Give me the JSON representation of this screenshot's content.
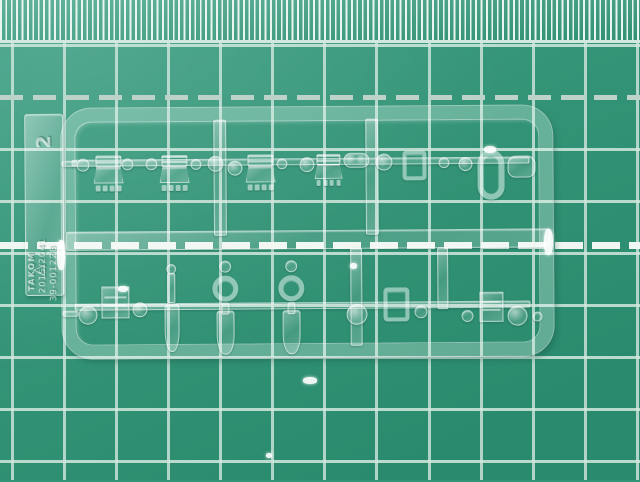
{
  "scene": {
    "description": "Clear transparent plastic model-kit sprue (parts tree) lying on a green self-healing cutting mat with white grid lines",
    "width_px": 640,
    "height_px": 480
  },
  "palette": {
    "mat_green": "#339376",
    "mat_green_light": "#41a287",
    "mat_green_dark": "#2a8a6d",
    "hatch_line": "#e9f5ef",
    "grid_line": "#d2e7de",
    "dash_minor": "#bdd3ca",
    "dash_major": "#f0f6f1"
  },
  "mat": {
    "hatch_band": {
      "height": 43
    },
    "grid": {
      "square_px": 52,
      "vlines": [
        11,
        63,
        115,
        167,
        219,
        271,
        323,
        375,
        428,
        480,
        532,
        584,
        636
      ],
      "hlines": [
        44,
        148,
        200,
        252,
        304,
        356,
        408,
        460
      ],
      "dashed_minor_y": 95,
      "dashed_major_y": 242
    }
  },
  "sprue": {
    "frame": {
      "x": 62,
      "y": 107,
      "w": 491,
      "h": 250,
      "bar_thickness": 13,
      "corner_radius": 30
    },
    "label_tab": {
      "sprue_letter": "2",
      "brand": "TAKOM",
      "code_line1": "2015/2041",
      "code_line2": "39-001228",
      "recycle_symbol": "△"
    },
    "runners": [
      {
        "x": 72,
        "y": 158,
        "w": 458,
        "h": 7
      },
      {
        "x": 66,
        "y": 230,
        "w": 484,
        "h": 19
      },
      {
        "x": 74,
        "y": 302,
        "w": 456,
        "h": 7
      },
      {
        "x": 214,
        "y": 119,
        "w": 13,
        "h": 116
      },
      {
        "x": 366,
        "y": 119,
        "w": 13,
        "h": 116
      },
      {
        "x": 350,
        "y": 248,
        "w": 12,
        "h": 98
      },
      {
        "x": 437,
        "y": 248,
        "w": 11,
        "h": 62
      },
      {
        "x": 62,
        "y": 309,
        "w": 16,
        "h": 6
      },
      {
        "x": 62,
        "y": 159,
        "w": 16,
        "h": 6
      }
    ],
    "parts_top": [
      {
        "type": "disc",
        "x": 83,
        "y": 163,
        "w": 13
      },
      {
        "type": "boxpins",
        "x": 109,
        "y": 172,
        "w": 30,
        "h": 36
      },
      {
        "type": "disc",
        "x": 128,
        "y": 163,
        "w": 12
      },
      {
        "type": "disc",
        "x": 152,
        "y": 163,
        "w": 12
      },
      {
        "type": "boxpins",
        "x": 175,
        "y": 172,
        "w": 30,
        "h": 36
      },
      {
        "type": "disc",
        "x": 196,
        "y": 163,
        "w": 11
      },
      {
        "type": "dome",
        "x": 216,
        "y": 163,
        "w": 16
      },
      {
        "type": "dome",
        "x": 235,
        "y": 167,
        "w": 15
      },
      {
        "type": "boxpins",
        "x": 261,
        "y": 172,
        "w": 30,
        "h": 36
      },
      {
        "type": "disc",
        "x": 282,
        "y": 163,
        "w": 11
      },
      {
        "type": "dome",
        "x": 307,
        "y": 164,
        "w": 15
      },
      {
        "type": "boxpins",
        "x": 329,
        "y": 170,
        "w": 28,
        "h": 32
      },
      {
        "type": "capsule",
        "x": 357,
        "y": 160,
        "w": 26,
        "h": 15
      },
      {
        "type": "dome",
        "x": 384,
        "y": 162,
        "w": 17
      },
      {
        "type": "bracket",
        "x": 415,
        "y": 166,
        "w": 24,
        "h": 30
      },
      {
        "type": "disc",
        "x": 444,
        "y": 163,
        "w": 11
      },
      {
        "type": "dome",
        "x": 466,
        "y": 165,
        "w": 14
      },
      {
        "type": "ring",
        "x": 491,
        "y": 176,
        "w": 27,
        "h": 50
      },
      {
        "type": "blob",
        "x": 522,
        "y": 168,
        "w": 28,
        "h": 22
      }
    ],
    "parts_bottom": [
      {
        "type": "dome",
        "x": 87,
        "y": 313,
        "w": 19
      },
      {
        "type": "boxgrid",
        "x": 115,
        "y": 301,
        "w": 28,
        "h": 32
      },
      {
        "type": "dome",
        "x": 139,
        "y": 308,
        "w": 15
      },
      {
        "type": "periscope",
        "x": 171,
        "y": 307,
        "w": 17,
        "h": 88
      },
      {
        "type": "periscope2",
        "x": 225,
        "y": 307,
        "w": 26,
        "h": 94
      },
      {
        "type": "periscope2",
        "x": 291,
        "y": 307,
        "w": 26,
        "h": 94
      },
      {
        "type": "dome",
        "x": 356,
        "y": 314,
        "w": 21
      },
      {
        "type": "bracket",
        "x": 396,
        "y": 305,
        "w": 26,
        "h": 34
      },
      {
        "type": "disc",
        "x": 420,
        "y": 312,
        "w": 13
      },
      {
        "type": "disc",
        "x": 467,
        "y": 317,
        "w": 12
      },
      {
        "type": "boxgrid",
        "x": 491,
        "y": 308,
        "w": 24,
        "h": 30
      },
      {
        "type": "dome",
        "x": 517,
        "y": 317,
        "w": 20
      },
      {
        "type": "disc",
        "x": 537,
        "y": 318,
        "w": 10
      }
    ],
    "glints": [
      {
        "x": 57,
        "y": 240,
        "w": 8,
        "h": 30
      },
      {
        "x": 544,
        "y": 229,
        "w": 9,
        "h": 26
      },
      {
        "x": 484,
        "y": 146,
        "w": 12,
        "h": 7
      },
      {
        "x": 350,
        "y": 263,
        "w": 7,
        "h": 6
      },
      {
        "x": 118,
        "y": 286,
        "w": 10,
        "h": 6
      },
      {
        "x": 303,
        "y": 377,
        "w": 14,
        "h": 7
      },
      {
        "x": 266,
        "y": 453,
        "w": 6,
        "h": 5
      }
    ]
  }
}
